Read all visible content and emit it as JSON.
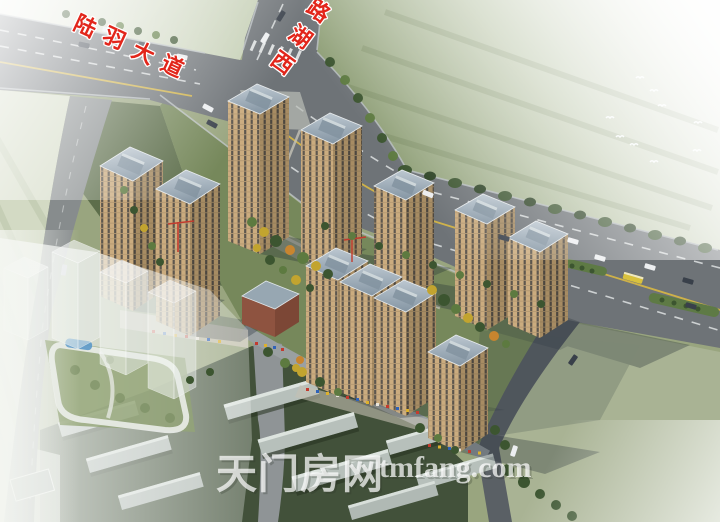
{
  "image": {
    "kind": "aerial architectural rendering of a residential development at a road junction",
    "road_labels": {
      "luyu_avenue": {
        "text": "陆羽大道",
        "chars": [
          "陆",
          "羽",
          "大",
          "道"
        ]
      },
      "xihu_road": {
        "text": "西湖路",
        "chars": [
          "西",
          "湖",
          "路"
        ]
      }
    },
    "watermark": {
      "site_name": "天门房网",
      "site_url": "tmfang.com"
    },
    "palette": {
      "label_red": "#e2261b",
      "label_outline": "#ffffff",
      "asphalt": "#6e7377",
      "lane_yellow": "#d8b844",
      "site_lawn": "#76885b",
      "field_dark": "#42513a",
      "field_sage": "#a9b394",
      "facade_light": "#cbac7f",
      "facade_shade": "#a78c63",
      "roof_gray": "#9badbb",
      "tree_dark": "#3c5530",
      "watermark_white": "#ffffff"
    }
  }
}
